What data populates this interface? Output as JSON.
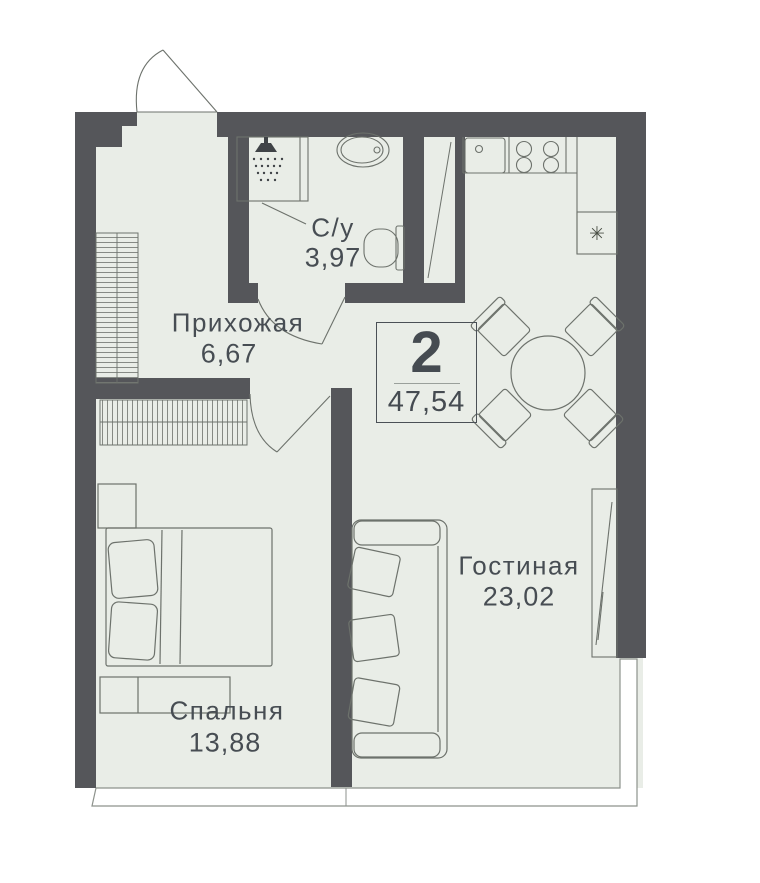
{
  "plan": {
    "type": "2-room apartment floor plan",
    "summary": {
      "rooms_count": "2",
      "total_area": "47,54"
    },
    "rooms": [
      {
        "key": "hallway",
        "label": "Прихожая",
        "area": "6,67"
      },
      {
        "key": "bathroom",
        "label": "С/у",
        "area": "3,97"
      },
      {
        "key": "living_room",
        "label": "Гостиная",
        "area": "23,02"
      },
      {
        "key": "bedroom",
        "label": "Спальня",
        "area": "13,88"
      }
    ],
    "icons": {
      "fridge_symbol": "✳"
    },
    "colors": {
      "wall": "#55565a",
      "floor": "#e9ede7",
      "line": "#6d726c",
      "text": "#474d53",
      "background": "#ffffff"
    }
  }
}
